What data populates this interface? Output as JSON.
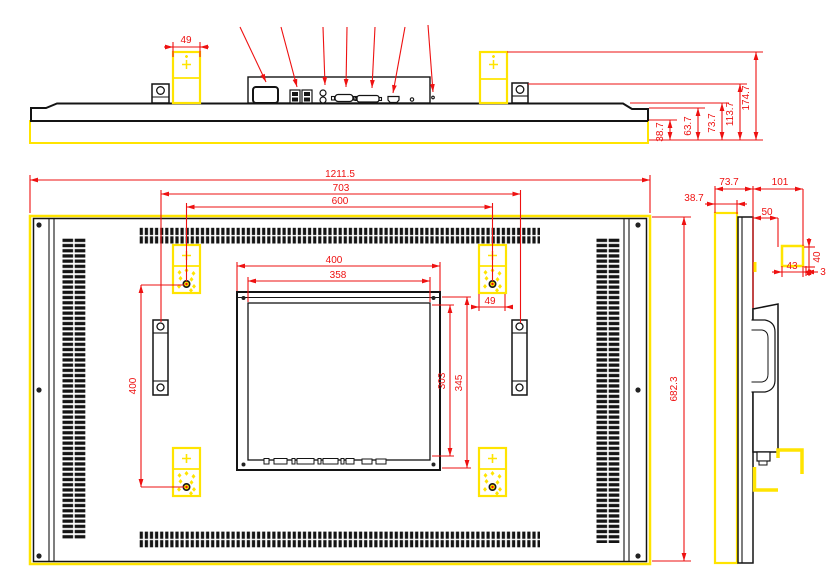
{
  "colors": {
    "dimension_red": "#ee1111",
    "highlight_yellow": "#ffe400",
    "line_black": "#141414"
  },
  "top_view": {
    "dim_bracket_width": "49",
    "dim_depth_1": "38.7",
    "dim_depth_2": "63.7",
    "dim_depth_3": "73.7",
    "dim_depth_4": "113.7",
    "dim_depth_5": "174.7",
    "ports": [
      "power-inlet",
      "usb-ports",
      "audio-jacks",
      "vga-connector",
      "dvi-connector",
      "hdmi-connector",
      "pinhole"
    ]
  },
  "rear_view": {
    "dim_overall_width": "1211.5",
    "dim_bracket_span": "703",
    "dim_hole_span_horizontal": "600",
    "dim_hole_span_vertical": "400",
    "dim_plate_width": "400",
    "dim_plate_opening_width": "358",
    "dim_plate_height": "345",
    "dim_plate_opening_height": "303",
    "dim_bracket_width": "49",
    "dim_overall_height": "682.3"
  },
  "side_view": {
    "dim_total_depth": "73.7",
    "dim_mount_depth": "101",
    "dim_front_thickness": "38.7",
    "dim_rail_depth": "50",
    "dim_hook_height": "40",
    "dim_hook_depth": "43",
    "dim_hook_gap": "3"
  }
}
